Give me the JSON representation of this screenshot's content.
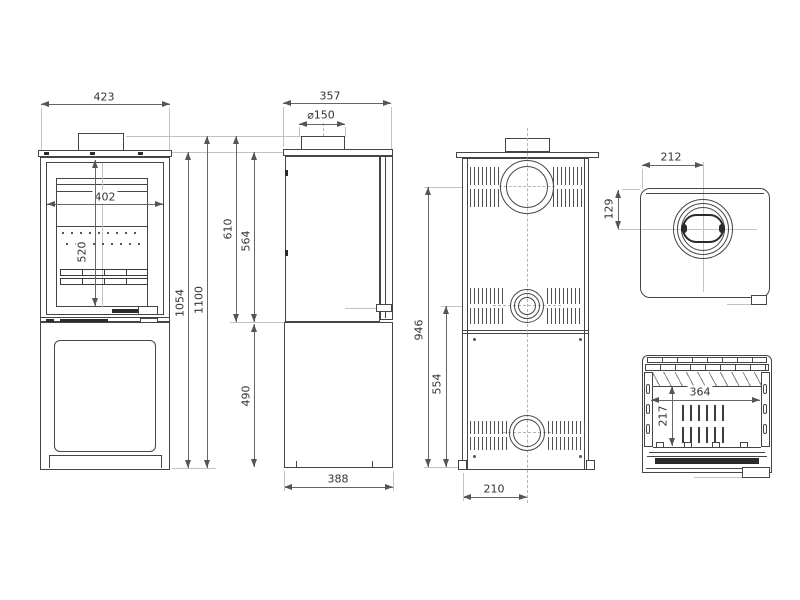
{
  "views": {
    "front": {
      "overall_width": "423",
      "door_width": "402",
      "glass_height": "520",
      "body_height": "1054",
      "overall_height": "1100"
    },
    "side": {
      "overall_depth": "357",
      "flue_diameter": "⌀150",
      "collar_top_to_base": "610",
      "plate_to_base": "564",
      "base_height": "490",
      "base_depth": "388"
    },
    "back": {
      "flue_center_height": "946",
      "rear_outlet_height": "554",
      "flue_offset": "210"
    },
    "top": {
      "flue_center_from_side": "212",
      "flue_center_from_back": "129"
    },
    "firebox": {
      "opening_width": "364",
      "opening_height": "217"
    }
  }
}
